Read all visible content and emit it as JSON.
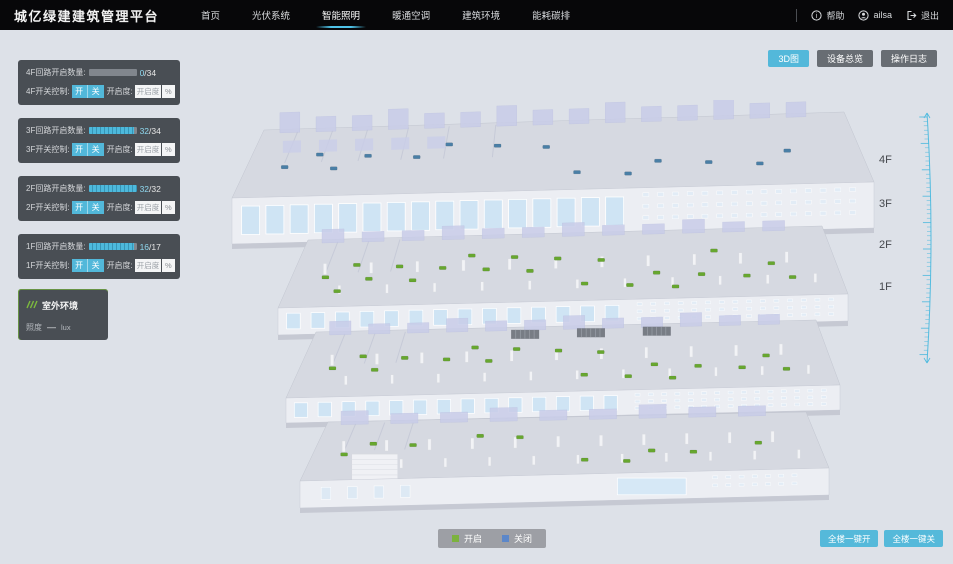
{
  "app": {
    "title": "城亿绿建建筑管理平台"
  },
  "nav": {
    "items": [
      {
        "label": "首页",
        "active": false
      },
      {
        "label": "光伏系统",
        "active": false
      },
      {
        "label": "智能照明",
        "active": true
      },
      {
        "label": "暖通空调",
        "active": false
      },
      {
        "label": "建筑环境",
        "active": false
      },
      {
        "label": "能耗碳排",
        "active": false
      }
    ],
    "help_label": "帮助",
    "user_name": "ailsa",
    "logout_label": "退出"
  },
  "view_buttons": [
    {
      "label": "3D图",
      "active": true
    },
    {
      "label": "设备总览",
      "active": false
    },
    {
      "label": "操作日志",
      "active": false
    }
  ],
  "sep": "/",
  "floor_panels": [
    {
      "count_label": "4F回路开启数量:",
      "open": 0,
      "total": 34,
      "switch_label": "4F开关控制:",
      "on_label": "开",
      "off_label": "关",
      "dim_label": "开启度:",
      "dim_placeholder": "开启度",
      "percent_label": "%"
    },
    {
      "count_label": "3F回路开启数量:",
      "open": 32,
      "total": 34,
      "switch_label": "3F开关控制:",
      "on_label": "开",
      "off_label": "关",
      "dim_label": "开启度:",
      "dim_placeholder": "开启度",
      "percent_label": "%"
    },
    {
      "count_label": "2F回路开启数量:",
      "open": 32,
      "total": 32,
      "switch_label": "2F开关控制:",
      "on_label": "开",
      "off_label": "关",
      "dim_label": "开启度:",
      "dim_placeholder": "开启度",
      "percent_label": "%"
    },
    {
      "count_label": "1F回路开启数量:",
      "open": 16,
      "total": 17,
      "switch_label": "1F开关控制:",
      "on_label": "开",
      "off_label": "关",
      "dim_label": "开启度:",
      "dim_placeholder": "开启度",
      "percent_label": "%"
    }
  ],
  "outdoor_panel": {
    "title": "室外环境",
    "metric_label": "照度",
    "metric_value": "—",
    "metric_unit": "lux"
  },
  "floor_labels": [
    {
      "label": "4F",
      "top": 154
    },
    {
      "label": "3F",
      "top": 198
    },
    {
      "label": "2F",
      "top": 239
    },
    {
      "label": "1F",
      "top": 281
    }
  ],
  "legend": {
    "on_label": "开启",
    "on_color": "#7cb23e",
    "off_label": "关闭",
    "off_color": "#5c87c9"
  },
  "bottom_buttons": [
    {
      "label": "全楼一键开"
    },
    {
      "label": "全楼一键关"
    }
  ],
  "colors": {
    "accent": "#53b8da",
    "nav_underline": "#4fc3e8",
    "panel_bg": "rgba(47,52,58,0.85)"
  },
  "building": {
    "floors": [
      {
        "name": "4F",
        "dot_color": "#4a7fa6",
        "dot_count": 14,
        "status": "closed"
      },
      {
        "name": "3F",
        "dot_color": "#67a72f",
        "dot_count": 22,
        "status": "open"
      },
      {
        "name": "2F",
        "dot_color": "#67a72f",
        "dot_count": 18,
        "status": "open"
      },
      {
        "name": "1F",
        "dot_color": "#67a72f",
        "dot_count": 10,
        "status": "open"
      }
    ]
  }
}
